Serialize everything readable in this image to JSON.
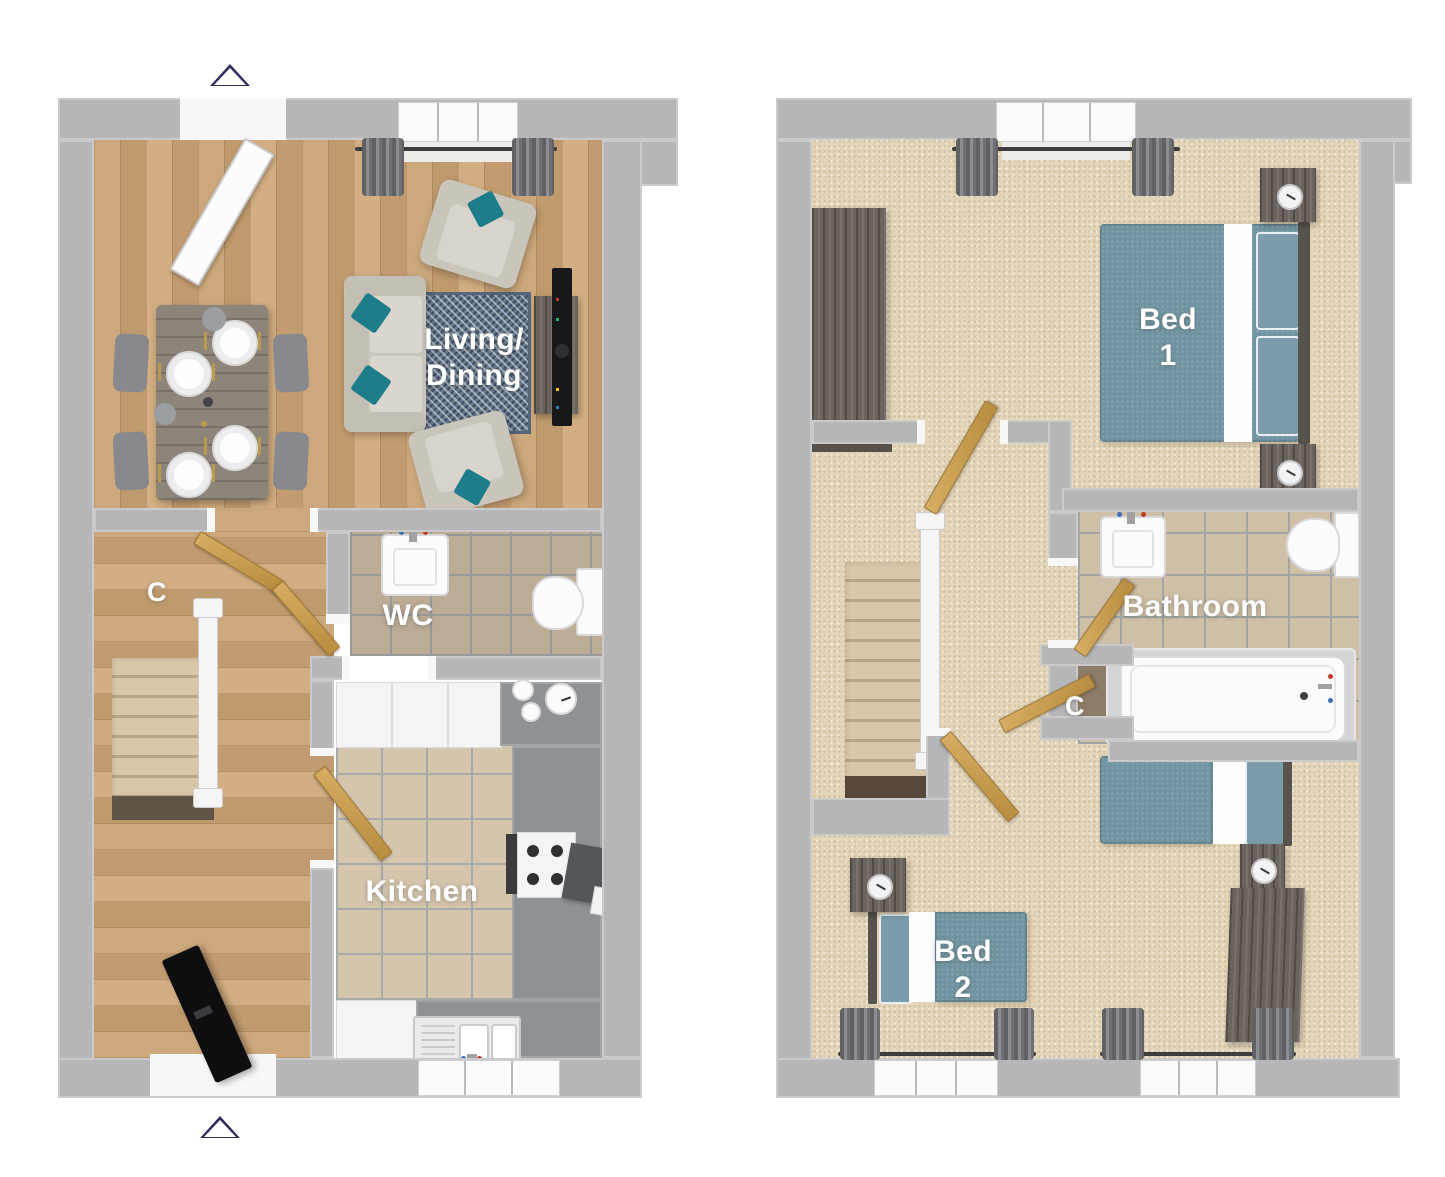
{
  "floor_plans": {
    "ground_floor": {
      "rooms": {
        "living_dining": {
          "label_line1": "Living/",
          "label_line2": "Dining"
        },
        "wc": {
          "label": "WC"
        },
        "kitchen": {
          "label": "Kitchen"
        },
        "cupboard": {
          "label": "C"
        }
      }
    },
    "first_floor": {
      "rooms": {
        "bed1": {
          "label_line1": "Bed",
          "label_line2": "1"
        },
        "bathroom": {
          "label": "Bathroom"
        },
        "bed2": {
          "label_line1": "Bed",
          "label_line2": "2"
        },
        "cupboard": {
          "label": "C"
        }
      }
    }
  },
  "markers": {
    "top": "triangle-up-outline",
    "bottom": "triangle-up-outline"
  },
  "colors": {
    "wall": "#b6b6b8",
    "wood_floor": "#c7a176",
    "carpet": "#e4d5b8",
    "kitchen_tile": "#d6c5ad",
    "bathroom_tile": "#cfbfa7",
    "counter_gray": "#8f9295",
    "teal_accent": "#1e7d8b",
    "bed_teal": "#7094a1",
    "door_wood": "#c49a52",
    "front_door": "#0e0e10",
    "dark_furniture": "#6b645e",
    "rug_blue": "#68798b",
    "label_text": "#ffffff",
    "marker_outline": "#2e2d5c"
  }
}
